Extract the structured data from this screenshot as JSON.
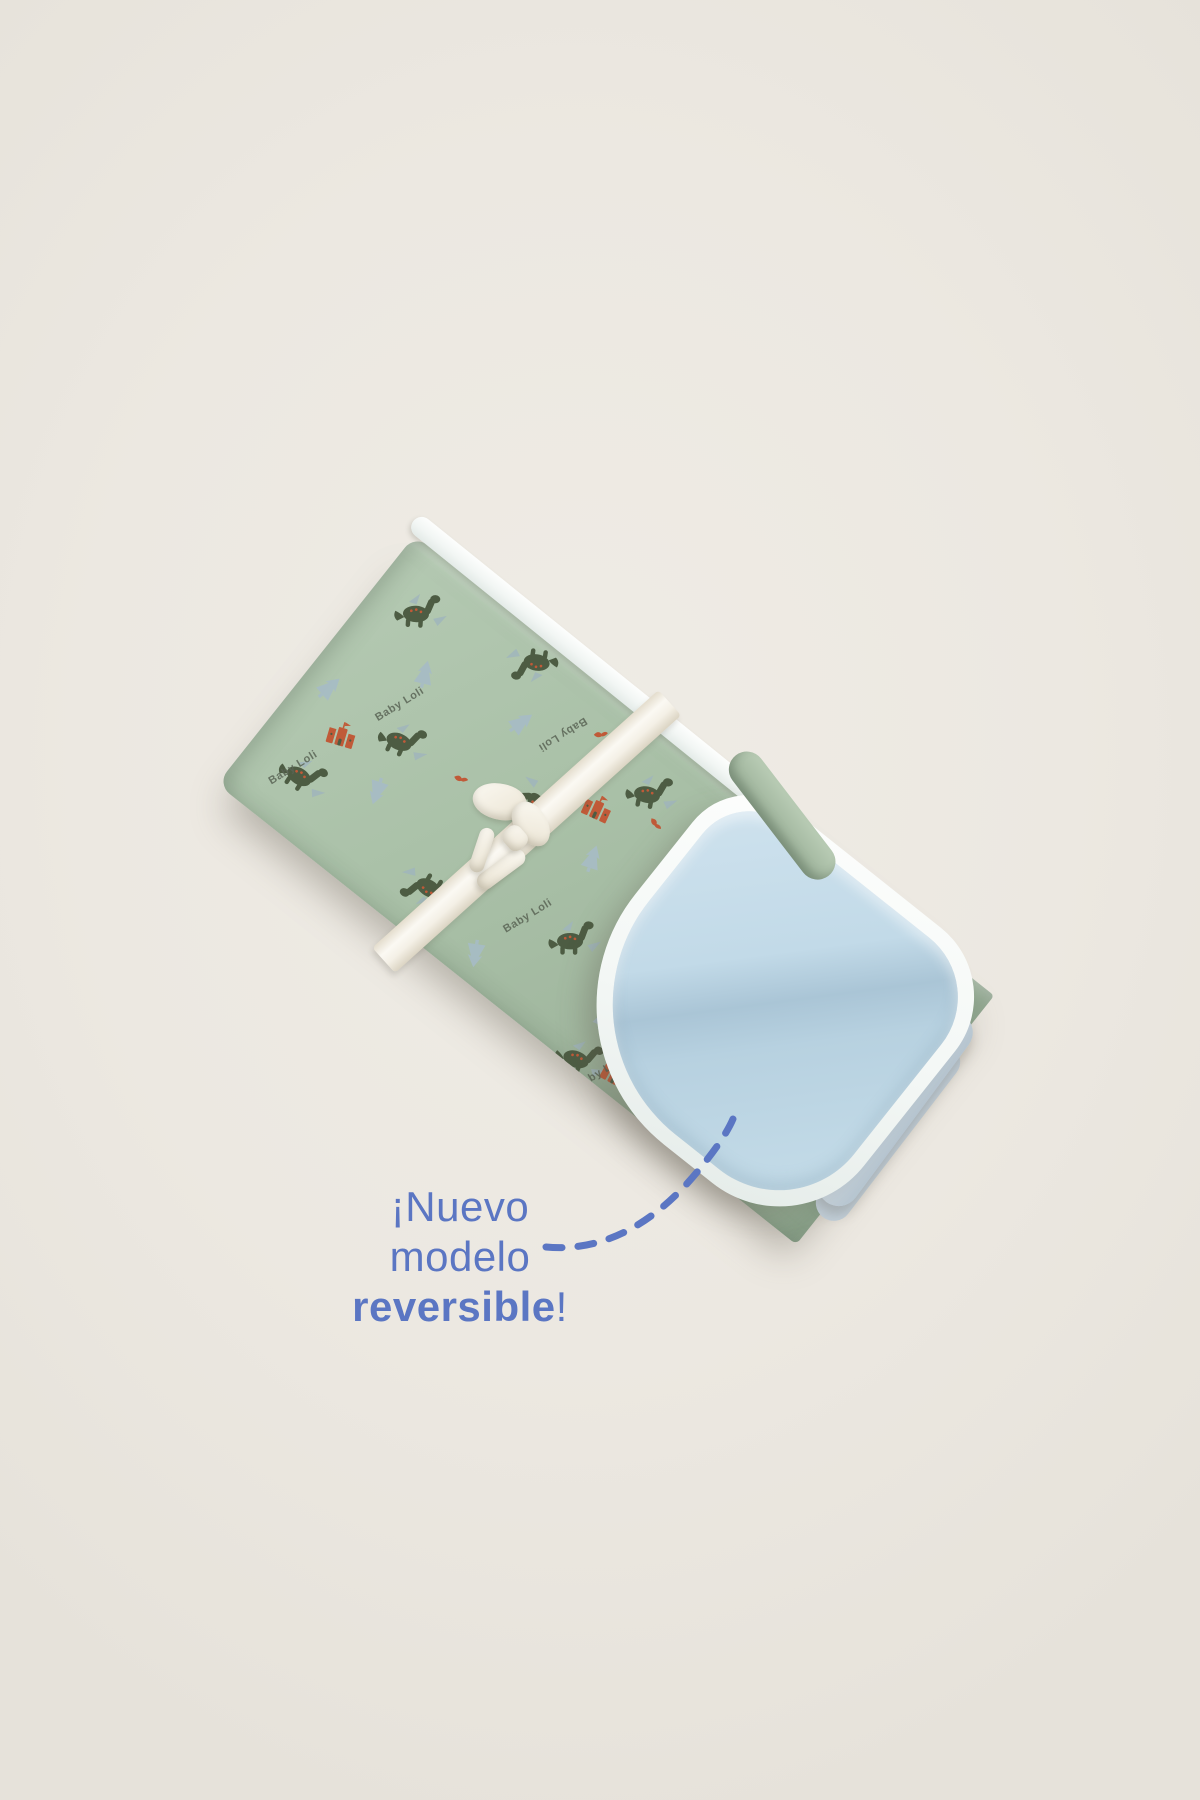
{
  "scene": {
    "description": "Studio product photo of a folded reversible baby blanket tied with a satin ribbon bow",
    "background_color": "#ece8e1"
  },
  "annotation": {
    "line1": "¡Nuevo",
    "line2": "modelo",
    "line3_emphasis": "reversible",
    "line3_punctuation": "!",
    "text_color": "#5b76c3",
    "pointer_style": "dashed curved line pointing to the folded blue lining"
  },
  "product": {
    "name": "reversible baby blanket",
    "state": "folded, corner turned back to show lining, tied with satin ribbon bow",
    "print_text": "Baby Loli",
    "front_fabric_color": "#a9c0a7",
    "lining_color": "#bdd7e6",
    "binding_trim_color": "#f5f8f6",
    "ribbon_color": "#f7f4ec",
    "pattern_motifs": [
      "dinosaur",
      "tree",
      "castle",
      "bird",
      "brand-text"
    ],
    "motif_colors": {
      "dinosaur": "#4d5c43",
      "dinosaur_spots": "#c05a38",
      "tree": "#a7bcc6",
      "castle": "#c05a38",
      "bird": "#c05a38",
      "print_text": "#5a6455"
    }
  }
}
